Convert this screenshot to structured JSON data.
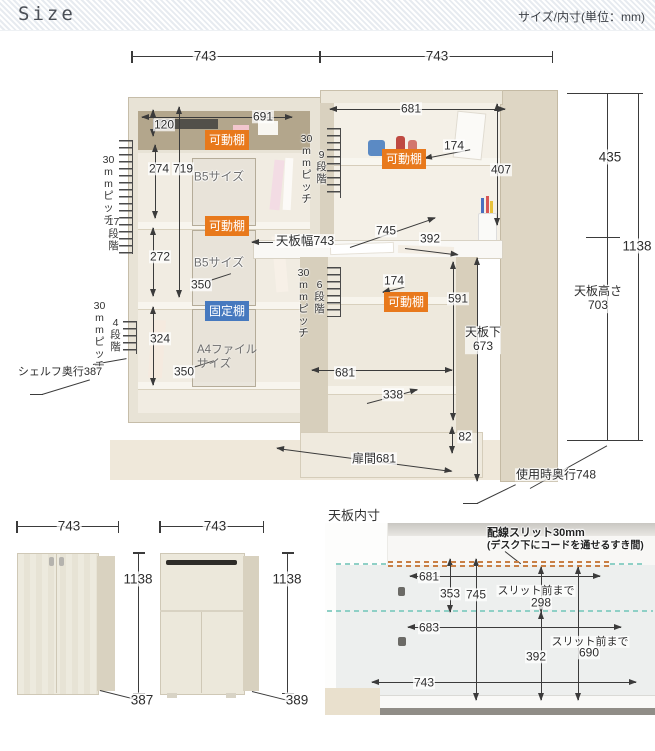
{
  "header": {
    "title": "Size",
    "subtitle": "サイズ/内寸(単位：mm)"
  },
  "tags": {
    "movable": "可動棚",
    "fixed": "固定棚"
  },
  "rulers": {
    "pitch": "30mmピッチ",
    "steps_17": "17段階",
    "steps_9": "9段階",
    "steps_6": "6段階",
    "steps_4": "4段階"
  },
  "main": {
    "width_left": "743",
    "width_right": "743",
    "shelf_unit": {
      "inner_width": "691",
      "top_section_h": "120",
      "upper_h": "274",
      "inner_h": "719",
      "b5_upper": "B5サイズ",
      "mid_h": "272",
      "depth_upper": "350",
      "b5_lower": "B5サイズ",
      "lower_h": "324",
      "a4": "A4ファイルサイズ",
      "depth_lower": "350",
      "depth_note": "シェルフ奥行387"
    },
    "hutch": {
      "inner_width": "681",
      "shelf_depth": "174",
      "inner_h": "407"
    },
    "desk": {
      "top_width": "天板幅743",
      "depth_full": "745",
      "depth_front": "392",
      "under_shelf_depth": "174",
      "under_h": "591",
      "under_clearance_label": "天板下",
      "under_clearance": "673",
      "under_width": "681",
      "bottom_shelf_depth": "338",
      "base_h": "82",
      "door_span": "扉間681",
      "use_depth": "使用時奥行748"
    },
    "right": {
      "upper_h": "435",
      "total_h": "1138",
      "desk_h_label": "天板高さ",
      "desk_h": "703"
    }
  },
  "closed": {
    "shelf_unit": {
      "w": "743",
      "h": "1138",
      "d": "387"
    },
    "desk_unit": {
      "w": "743",
      "h": "1138",
      "d": "389"
    }
  },
  "top_board": {
    "title": "天板内寸",
    "note1": "配線スリット30mm",
    "note2": "(デスク下にコードを通せるすき間)",
    "to_slit": "スリット前まで",
    "w_back": "681",
    "d_back": "353",
    "d_full": "745",
    "d_slit_back": "298",
    "w_mid": "683",
    "d_slit_front": "690",
    "d_front": "392",
    "w_front": "743"
  },
  "colors": {
    "movable_tag": "#e8791c",
    "fixed_tag": "#4679bf",
    "slit_line": "#c87f45",
    "fold_line": "#8fd0c6",
    "dim_line": "#3b3b3b"
  }
}
